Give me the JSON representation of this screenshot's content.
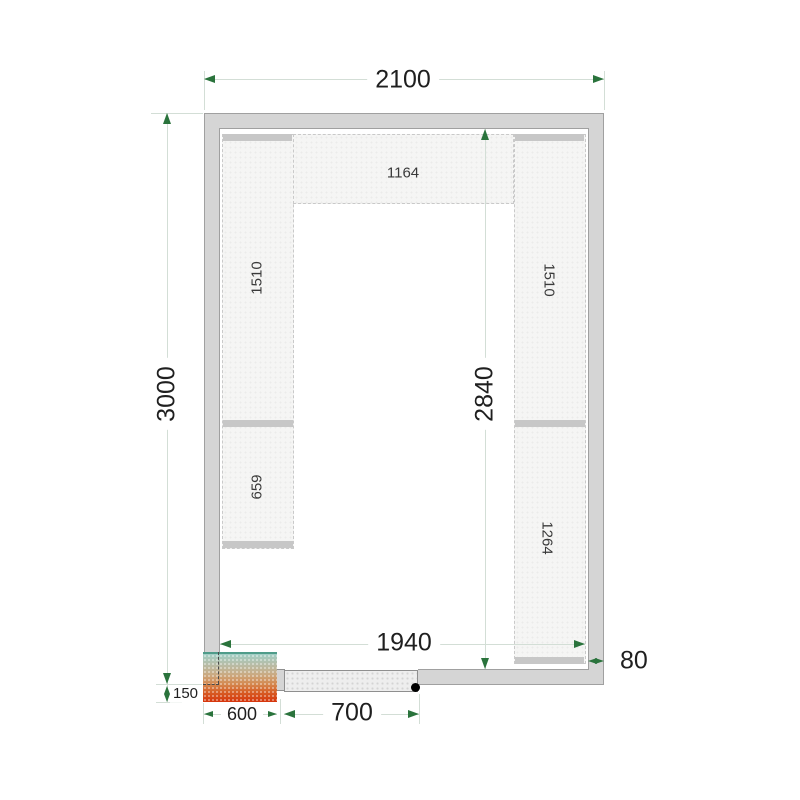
{
  "dims": {
    "outer_width": "2100",
    "outer_height": "3000",
    "inner_height": "2840",
    "inner_width": "1940",
    "wall_thickness": "80",
    "door_opening": "700",
    "unit_width": "600",
    "unit_offset": "150"
  },
  "shelves": {
    "top": "1164",
    "left_upper": "1510",
    "left_lower": "659",
    "right_upper": "1510",
    "right_lower": "1264"
  },
  "colors": {
    "dim_arrow": "#2a733c",
    "dim_line": "#d3ded6",
    "wall_fill": "#d5d5d5",
    "shelf_fill": "#f5f5f4",
    "shelf_bar": "#c7c7c7",
    "unit_gradient_top": "#a1cfc5",
    "unit_gradient_bottom": "#d6350c",
    "door_fill": "#eeeeee"
  }
}
